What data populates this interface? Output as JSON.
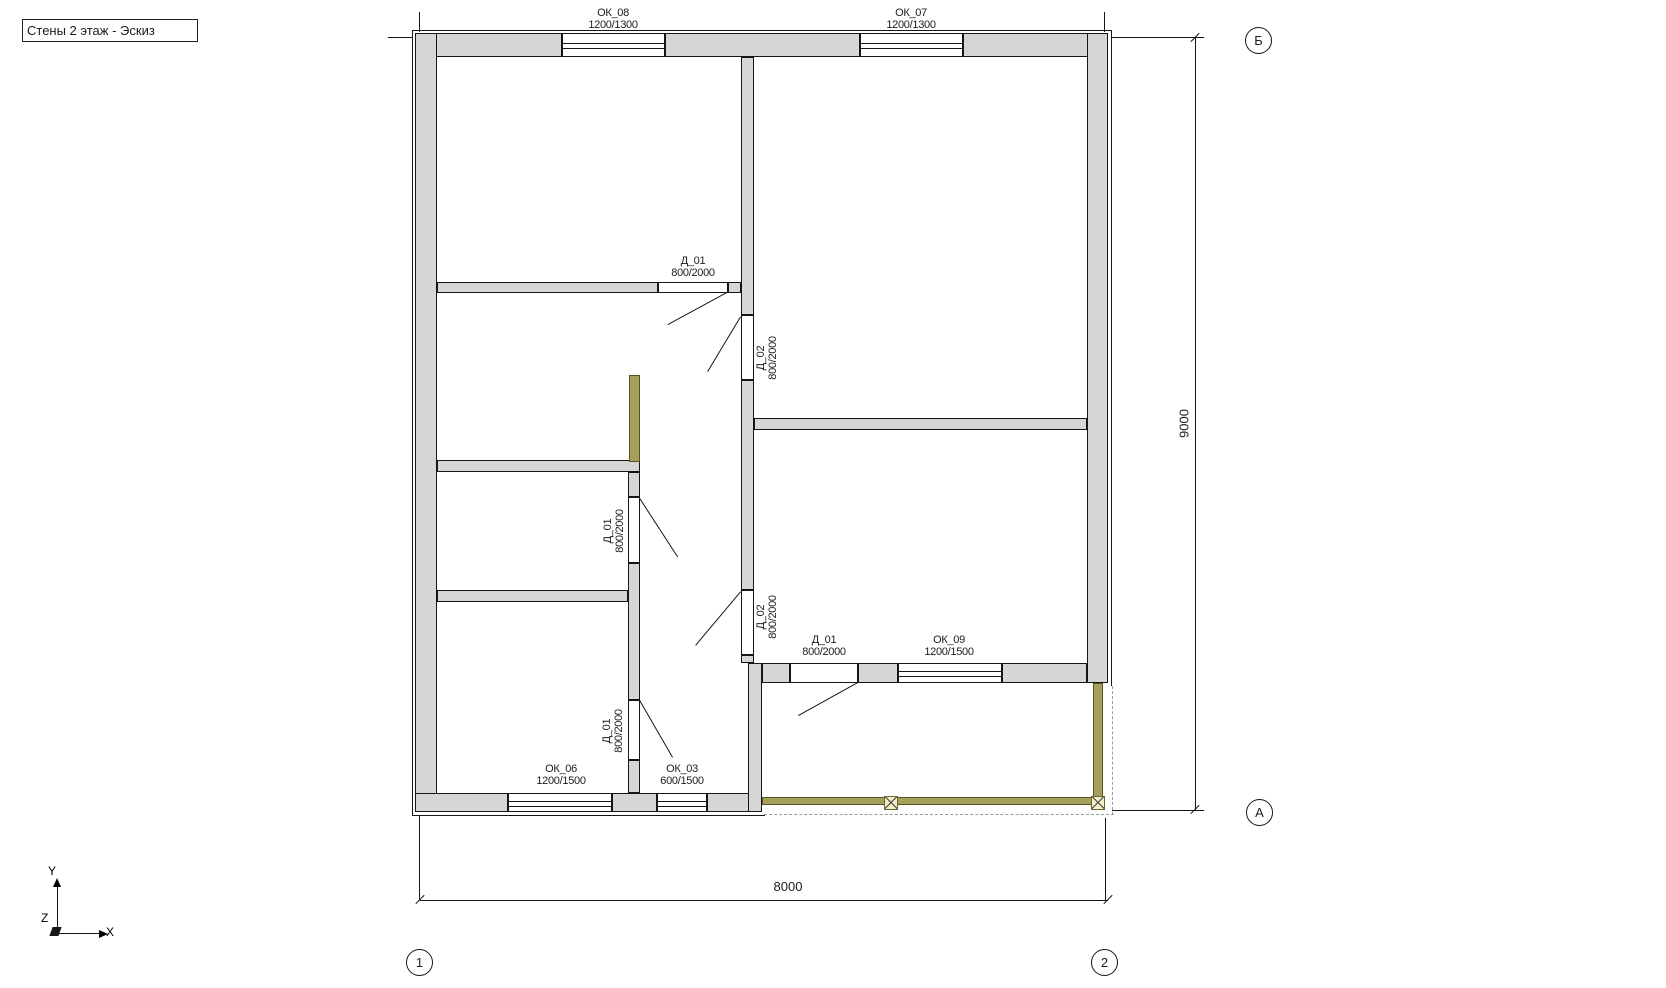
{
  "title": "Стены 2 этаж - Эскиз",
  "windows": {
    "ok08": {
      "id": "ОК_08",
      "size": "1200/1300"
    },
    "ok07": {
      "id": "ОК_07",
      "size": "1200/1300"
    },
    "ok09": {
      "id": "ОК_09",
      "size": "1200/1500"
    },
    "ok06": {
      "id": "ОК_06",
      "size": "1200/1500"
    },
    "ok03": {
      "id": "ОК_03",
      "size": "600/1500"
    }
  },
  "doors": {
    "d01": {
      "id": "Д_01",
      "size": "800/2000"
    },
    "d02": {
      "id": "Д_02",
      "size": "800/2000"
    }
  },
  "dimensions": {
    "vertical": "9000",
    "horizontal": "8000"
  },
  "grid_marks": {
    "top_right": "Б",
    "bottom_right": "А",
    "col1": "1",
    "col2": "2"
  },
  "ucs": {
    "x": "X",
    "y": "Y",
    "z": "Z"
  },
  "colors": {
    "wall_fill": "#d6d6d6",
    "line": "#161616",
    "highlight_wall": "#a6a05c",
    "post_fill": "#f2eec8",
    "dash": "#9a9a9a"
  }
}
